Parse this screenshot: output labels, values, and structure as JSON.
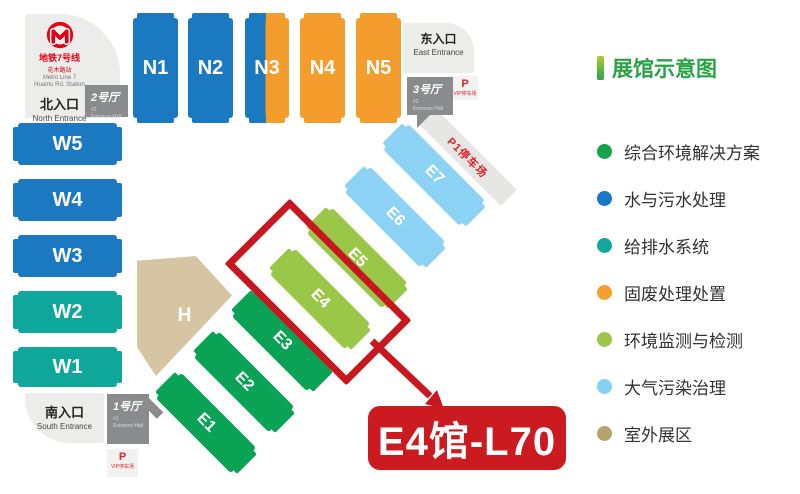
{
  "map": {
    "metro": {
      "line_zh": "地铁7号线",
      "station_zh": "花木路站",
      "line_en": "Metro Line 7",
      "station_en": "Huamu Rd. Station"
    },
    "entrances": {
      "north": {
        "zh": "北入口",
        "en": "North Entrance"
      },
      "east": {
        "zh": "东入口",
        "en": "East Entrance"
      },
      "south": {
        "zh": "南入口",
        "en": "South Entrance"
      }
    },
    "entrance_halls": {
      "h1": {
        "zh": "1号厅",
        "num": "#1",
        "en": "Entrance Hall"
      },
      "h2": {
        "zh": "2号厅",
        "num": "#2",
        "en": "Entrance Hall"
      },
      "h3": {
        "zh": "3号厅",
        "num": "#3",
        "en": "Entrance Hall"
      }
    },
    "parking": {
      "p": "P",
      "vip_label": "VIP停车场",
      "p1_label": "P1停车场"
    },
    "halls": {
      "n1": "N1",
      "n2": "N2",
      "n3": "N3",
      "n4": "N4",
      "n5": "N5",
      "w1": "W1",
      "w2": "W2",
      "w3": "W3",
      "w4": "W4",
      "w5": "W5",
      "e1": "E1",
      "e2": "E2",
      "e3": "E3",
      "e4": "E4",
      "e5": "E5",
      "e6": "E6",
      "e7": "E7",
      "h": "H"
    },
    "highlight": {
      "label": "E4馆-L70"
    }
  },
  "legend": {
    "title": "展馆示意图",
    "items": [
      {
        "label": "综合环境解决方案",
        "color": "#1aa14b"
      },
      {
        "label": "水与污水处理",
        "color": "#1a78c6"
      },
      {
        "label": "给排水系统",
        "color": "#14a79d"
      },
      {
        "label": "固废处理处置",
        "color": "#f5a02c"
      },
      {
        "label": "环境监测与检测",
        "color": "#9cc649"
      },
      {
        "label": "大气污染治理",
        "color": "#85d1f5"
      },
      {
        "label": "室外展区",
        "color": "#b3a46c"
      }
    ]
  },
  "colors": {
    "blue": "#1b79c2",
    "teal": "#0fa69b",
    "orange": "#f49d2d",
    "dark_green": "#0aa254",
    "light_green": "#9bc748",
    "light_blue": "#8bd2f5",
    "tan": "#d6c5a2",
    "highlight_red": "#c8171e",
    "label_red": "#cb1a20",
    "metro_red": "#e60012",
    "entrance_gray": "#ececea",
    "hall_box_gray": "#8a8b8d"
  }
}
